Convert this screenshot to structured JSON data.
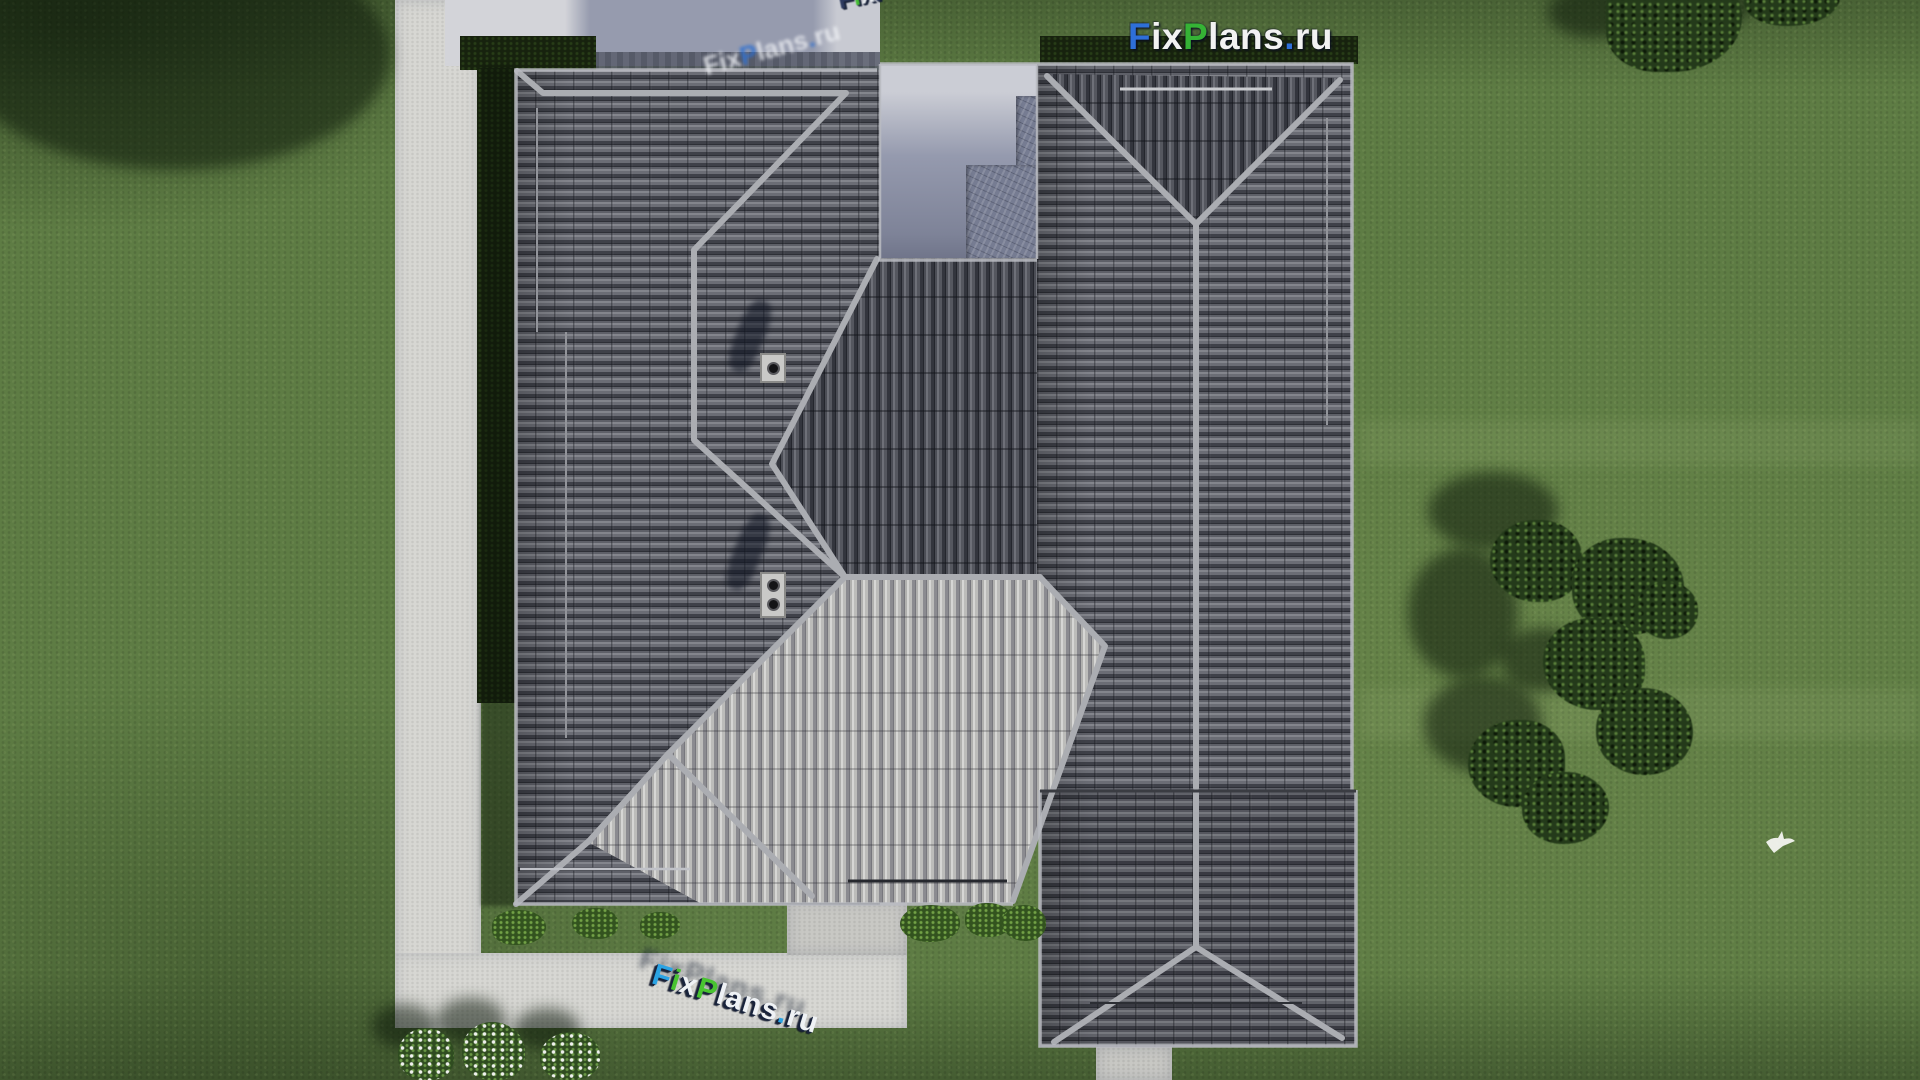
{
  "watermarks": {
    "brand": "FixPlans.ru",
    "top_logo_letters": [
      {
        "ch": "F",
        "c": "#2e6fd8"
      },
      {
        "ch": "i",
        "c": "#f2f2f2"
      },
      {
        "ch": "x",
        "c": "#f2f2f2"
      },
      {
        "ch": "P",
        "c": "#35b335"
      },
      {
        "ch": "l",
        "c": "#f2f2f2"
      },
      {
        "ch": "a",
        "c": "#f2f2f2"
      },
      {
        "ch": "n",
        "c": "#f2f2f2"
      },
      {
        "ch": "s",
        "c": "#f2f2f2"
      },
      {
        "ch": ".",
        "c": "#2e6fd8"
      },
      {
        "ch": "r",
        "c": "#f2f2f2"
      },
      {
        "ch": "u",
        "c": "#f2f2f2"
      }
    ],
    "roof_diagonal_letters": [
      {
        "ch": "F",
        "c": "#eef0f4"
      },
      {
        "ch": "i",
        "c": "#eef0f4"
      },
      {
        "ch": "x",
        "c": "#eef0f4"
      },
      {
        "ch": "P",
        "c": "#2a6fd4"
      },
      {
        "ch": "l",
        "c": "#eef0f4"
      },
      {
        "ch": "a",
        "c": "#eef0f4"
      },
      {
        "ch": "n",
        "c": "#eef0f4"
      },
      {
        "ch": "s",
        "c": "#eef0f4"
      },
      {
        "ch": ".",
        "c": "#2a6fd4"
      },
      {
        "ch": "r",
        "c": "#eef0f4"
      },
      {
        "ch": "u",
        "c": "#eef0f4"
      }
    ],
    "top_edge_letters": [
      {
        "ch": "F",
        "c": "#25335a"
      },
      {
        "ch": "i",
        "c": "#3fbe2d"
      },
      {
        "ch": "x",
        "c": "#e8ebf0"
      },
      {
        "ch": "P",
        "c": "#25335a"
      },
      {
        "ch": "l",
        "c": "#25335a"
      },
      {
        "ch": "a",
        "c": "#e8ebf0"
      },
      {
        "ch": "n",
        "c": "#25335a"
      },
      {
        "ch": "s",
        "c": "#25335a"
      },
      {
        "ch": ".",
        "c": "#2196dd"
      },
      {
        "ch": "r",
        "c": "#25335a"
      },
      {
        "ch": "u",
        "c": "#25335a"
      }
    ],
    "path_3d_letters": [
      {
        "ch": "F",
        "c": "#2aa3e4"
      },
      {
        "ch": "i",
        "c": "#49c431"
      },
      {
        "ch": "x",
        "c": "#eff2f5"
      },
      {
        "ch": "P",
        "c": "#49c431"
      },
      {
        "ch": "l",
        "c": "#eff2f5"
      },
      {
        "ch": "a",
        "c": "#eff2f5"
      },
      {
        "ch": "n",
        "c": "#eff2f5"
      },
      {
        "ch": "s",
        "c": "#eff2f5"
      },
      {
        "ch": ".",
        "c": "#2aa3e4"
      },
      {
        "ch": "r",
        "c": "#eff2f5"
      },
      {
        "ch": "u",
        "c": "#eff2f5"
      }
    ]
  },
  "colors": {
    "grass_base": "#5e7c44",
    "grass_shadow": "#2c4420",
    "path_gray": "#d7d7d3",
    "ridge_gray": "#abadb2",
    "roof_dark": "#54565e",
    "roof_light": "#b5b5b3",
    "concrete_shadow": "#969bae",
    "concrete_light": "#cdcfd6",
    "hedge_dark": "#17220e",
    "tree_green": "#243a1a",
    "brand_blue": "#2e6fd8",
    "brand_green": "#35b335",
    "letter_white": "#f2f2f2",
    "extrude_navy": "#141e36"
  },
  "scene": {
    "view": "top-down aerial render of a house with gray hip roofs",
    "bird": "white bird flying over lawn",
    "trees": "dark green tree clusters at top-right and mid-right",
    "bushes": "white flowering bushes along bottom walkway",
    "walkways": "light concrete paths on left and bottom",
    "chimneys": "two roof vent stacks casting shadows"
  }
}
